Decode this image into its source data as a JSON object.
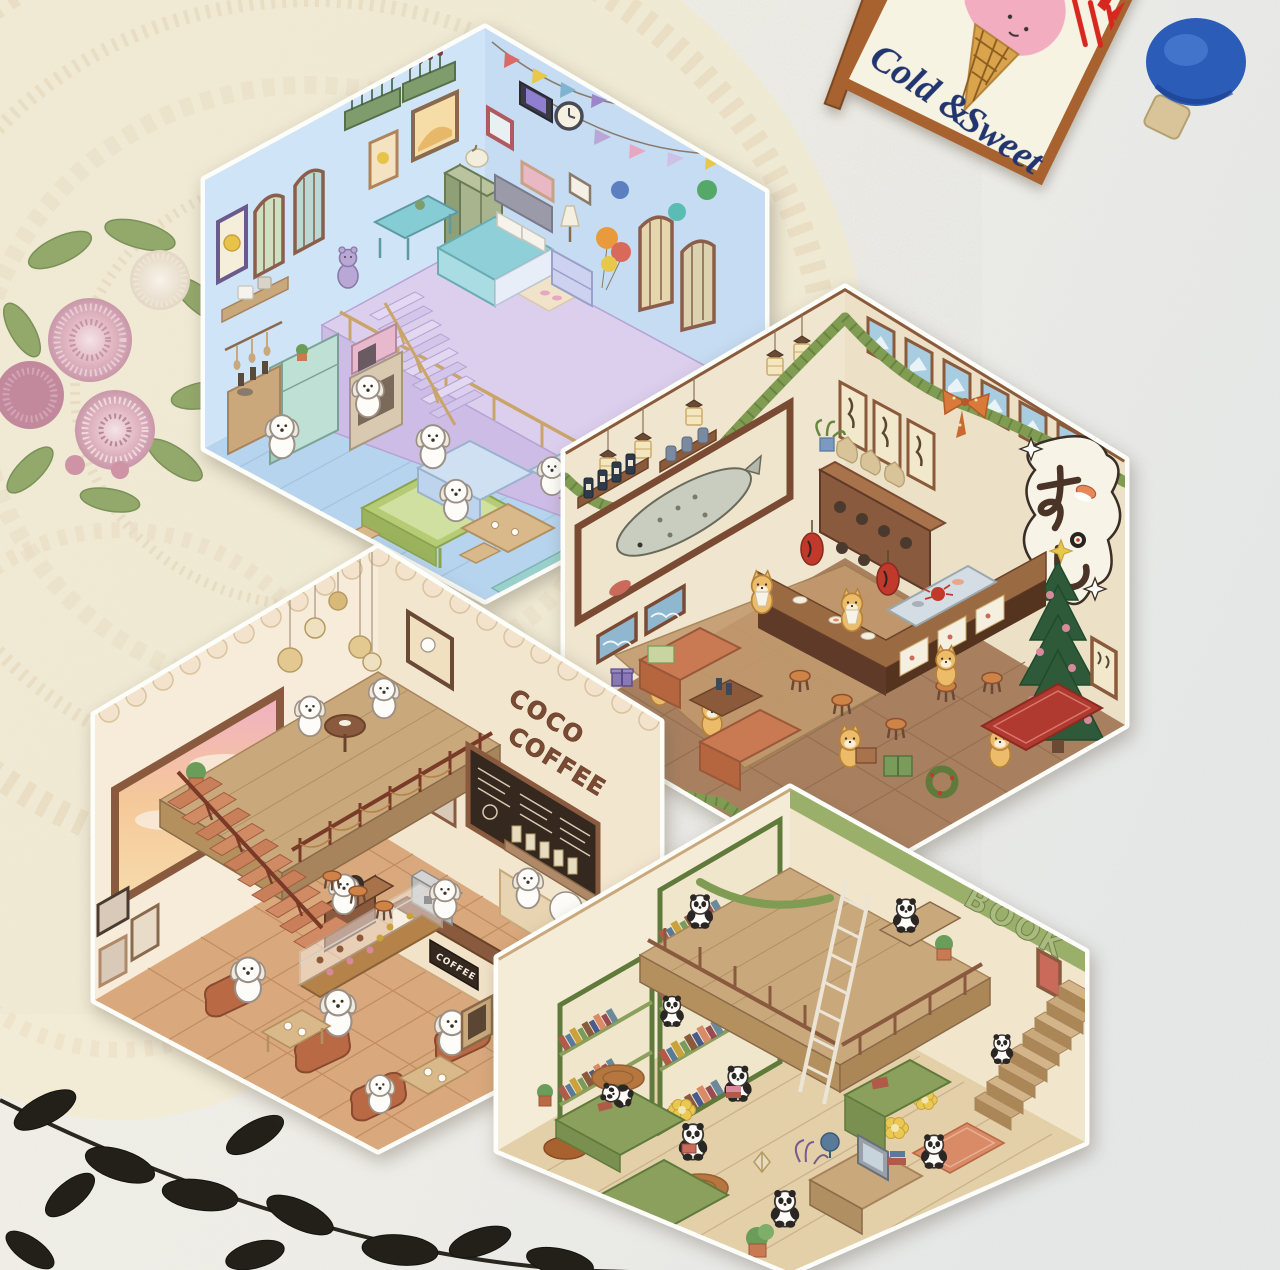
{
  "signboard": {
    "script_line1": "Cold &",
    "script_line2": "Sweet",
    "partial_red_text": "AM",
    "board_color": "#f6f3e2",
    "frame_color": "#a8622f",
    "script_color": "#23356e",
    "red_color": "#d6281e",
    "icecream_color": "#f2aec0"
  },
  "pin": {
    "color": "#2a5cb8"
  },
  "rooms": {
    "bedroom": {
      "wall_color": "#cfe4f6",
      "floor_color": "#b7d4ee",
      "loft_color": "#dccfee"
    },
    "sushi_bar": {
      "sign_text": "すし",
      "wall_color": "#f0e6cf",
      "floor_color": "#a9805f",
      "counter_color": "#5f3a28"
    },
    "coffee_shop": {
      "wall_text_line1": "COCO",
      "wall_text_line2": "COFFEE",
      "counter_sign_text": "COFFEE",
      "wall_color": "#f7ecd9",
      "floor_color": "#d9a87c"
    },
    "bookstore": {
      "wall_text_line1": "ENSEN",
      "wall_text_line2": "BOOK",
      "wall_color": "#f5ecd8",
      "shelf_color": "#8aa05c",
      "floor_color": "#e3cfa8"
    }
  },
  "background": {
    "plaster_color": "#f2f0ea",
    "lace_color": "#f3ecd6",
    "leaves_color": "#23201a",
    "embroidery_pink": "#d8a7b8",
    "embroidery_green": "#93a86b"
  }
}
